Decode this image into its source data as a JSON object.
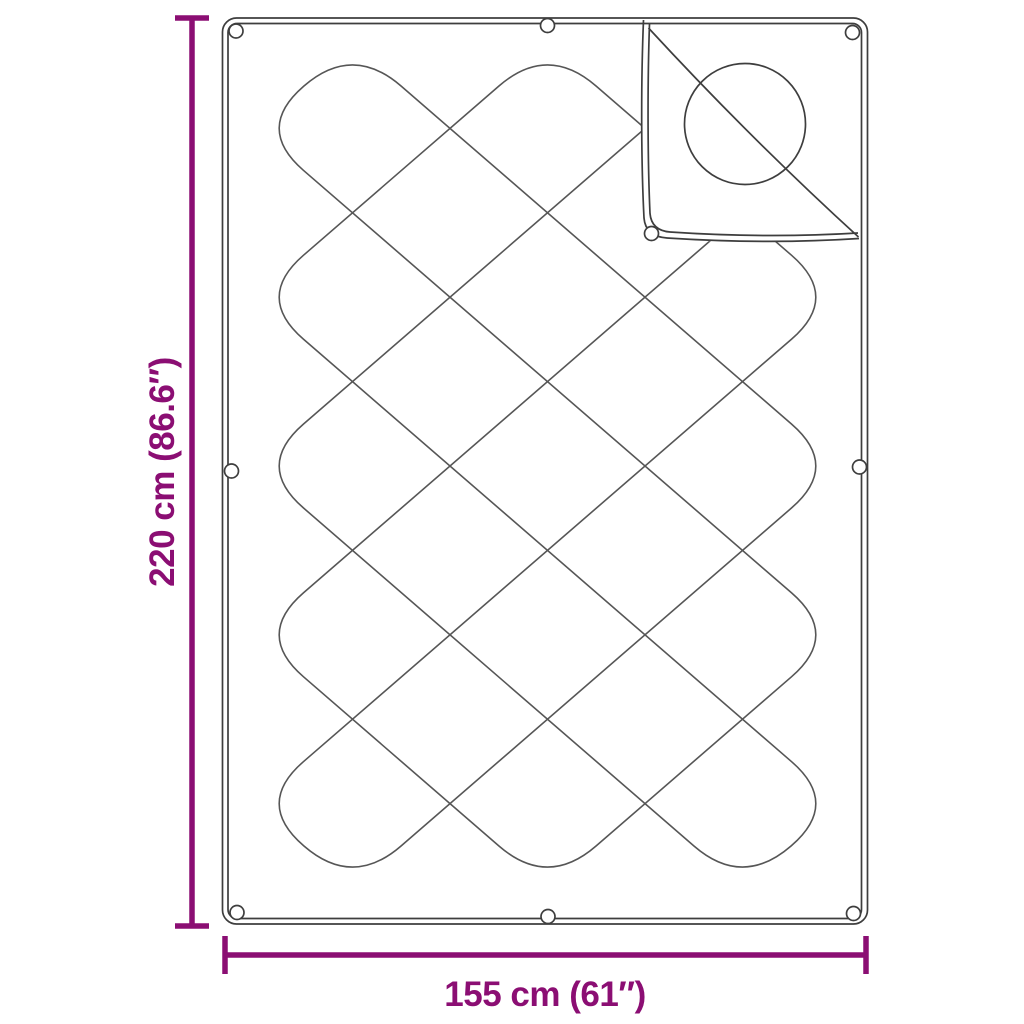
{
  "diagram": {
    "title": "Blanket dimension diagram",
    "subject": "quilted blanket with folded corner flap and snap fasteners",
    "height_label": "220 cm (86.6″)",
    "width_label": "155 cm (61″)",
    "accent_color": "#8B0E73",
    "outline_color": "#3E3E3E",
    "pattern_color": "#565656",
    "background_color": "#FFFFFF",
    "snap_fastener_count": 9
  }
}
